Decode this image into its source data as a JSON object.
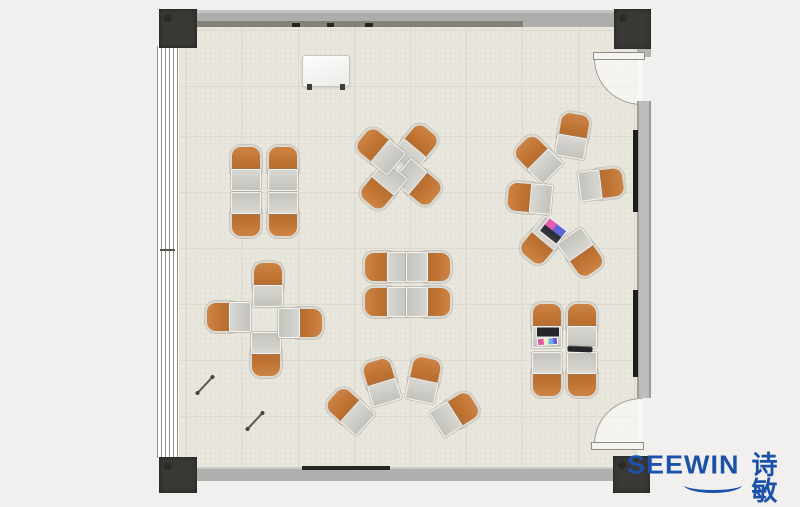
{
  "logo": {
    "brand": "SEEWIN",
    "cjk": "诗敏",
    "color": "#1a51a9"
  },
  "colors": {
    "floor": "#e9e7dd",
    "wall": "#b1b1af",
    "corner_post": "#3a3936",
    "chair_orange": "#bd7232",
    "desk_gray": "#c6c5c0",
    "brand_blue": "#1a51a9"
  },
  "floorplan": {
    "description": "Top-view classroom floor plan with 30 desk-chair units in 7 clusters",
    "clusters": [
      {
        "id": "cluster-top-left-2x2",
        "units": [
          {
            "x": 246,
            "y": 168,
            "rot": 0
          },
          {
            "x": 283,
            "y": 168,
            "rot": 0
          },
          {
            "x": 246,
            "y": 215,
            "rot": 180
          },
          {
            "x": 283,
            "y": 215,
            "rot": 180
          }
        ]
      },
      {
        "id": "cluster-top-mid-pinwheel",
        "units": [
          {
            "x": 416,
            "y": 147,
            "rot": 40
          },
          {
            "x": 419,
            "y": 184,
            "rot": 130
          },
          {
            "x": 382,
            "y": 187,
            "rot": 220
          },
          {
            "x": 379,
            "y": 150,
            "rot": -50
          }
        ]
      },
      {
        "id": "cluster-center-2x2",
        "units": [
          {
            "x": 386,
            "y": 267,
            "rot": -90
          },
          {
            "x": 386,
            "y": 302,
            "rot": -90
          },
          {
            "x": 429,
            "y": 267,
            "rot": 90
          },
          {
            "x": 429,
            "y": 302,
            "rot": 90
          }
        ]
      },
      {
        "id": "cluster-left-cross",
        "units": [
          {
            "x": 268,
            "y": 284,
            "rot": 0
          },
          {
            "x": 228,
            "y": 317,
            "rot": -90
          },
          {
            "x": 266,
            "y": 355,
            "rot": 180
          },
          {
            "x": 301,
            "y": 323,
            "rot": 90
          }
        ]
      },
      {
        "id": "cluster-bottom-arc",
        "units": [
          {
            "x": 349,
            "y": 410,
            "rot": -48
          },
          {
            "x": 381,
            "y": 381,
            "rot": -17
          },
          {
            "x": 424,
            "y": 379,
            "rot": 12
          },
          {
            "x": 456,
            "y": 413,
            "rot": 58
          }
        ]
      },
      {
        "id": "cluster-right-circle",
        "units": [
          {
            "x": 573,
            "y": 135,
            "rot": 10
          },
          {
            "x": 537,
            "y": 158,
            "rot": -45
          },
          {
            "x": 529,
            "y": 198,
            "rot": -85
          },
          {
            "x": 542,
            "y": 242,
            "rot": -140
          },
          {
            "x": 582,
            "y": 254,
            "rot": 145
          },
          {
            "x": 602,
            "y": 184,
            "rot": 83
          }
        ]
      },
      {
        "id": "cluster-bottom-right-2x2",
        "units": [
          {
            "x": 547,
            "y": 325,
            "rot": 0
          },
          {
            "x": 582,
            "y": 325,
            "rot": 0
          },
          {
            "x": 547,
            "y": 375,
            "rot": 180
          },
          {
            "x": 582,
            "y": 375,
            "rot": 180
          }
        ]
      }
    ],
    "props": [
      {
        "type": "whiteboard",
        "name": "mobile-whiteboard",
        "x": 326,
        "y": 71,
        "rot": 0
      },
      {
        "type": "stick",
        "name": "stick-object",
        "x": 205,
        "y": 385,
        "rot": -47
      },
      {
        "type": "stick",
        "name": "stick-object",
        "x": 255,
        "y": 421,
        "rot": -47
      },
      {
        "type": "laptop-colorful",
        "name": "open-laptop",
        "x": 553,
        "y": 231,
        "rot": 38
      },
      {
        "type": "laptop-notebook",
        "name": "laptop-with-notebook",
        "x": 548,
        "y": 336,
        "rot": 0
      },
      {
        "type": "tablet",
        "name": "closed-tablet",
        "x": 580,
        "y": 349,
        "rot": 2
      }
    ]
  }
}
